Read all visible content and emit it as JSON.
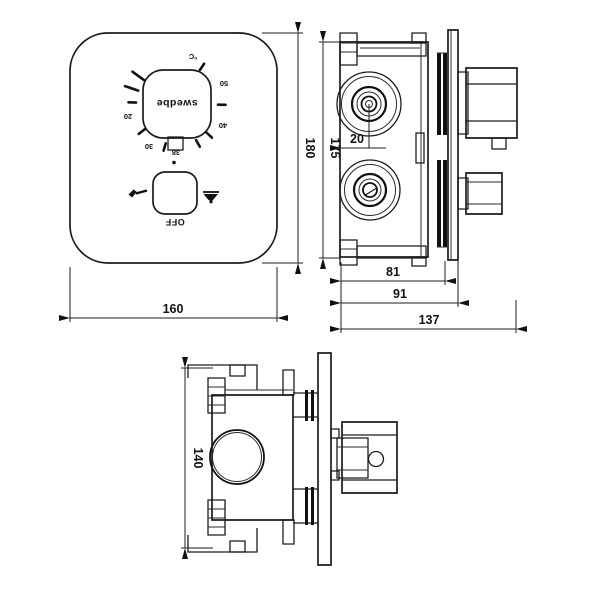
{
  "front": {
    "brand": "swedbe",
    "dial_scale": {
      "c": "°C",
      "n50": "50",
      "n40": "40",
      "n30": "30",
      "n20": "20",
      "n38": "38"
    },
    "off": "OFF"
  },
  "dims": {
    "front_width": "160",
    "front_height": "180",
    "body_height": "175",
    "valve_offset": "20",
    "depth_plate": "81",
    "depth_body": "91",
    "depth_total": "137",
    "bottom_height": "140"
  },
  "icons": {
    "left": "hand-shower-icon",
    "right": "overhead-shower-icon"
  },
  "colors": {
    "line": "#1c1c1c",
    "bg": "#ffffff"
  }
}
